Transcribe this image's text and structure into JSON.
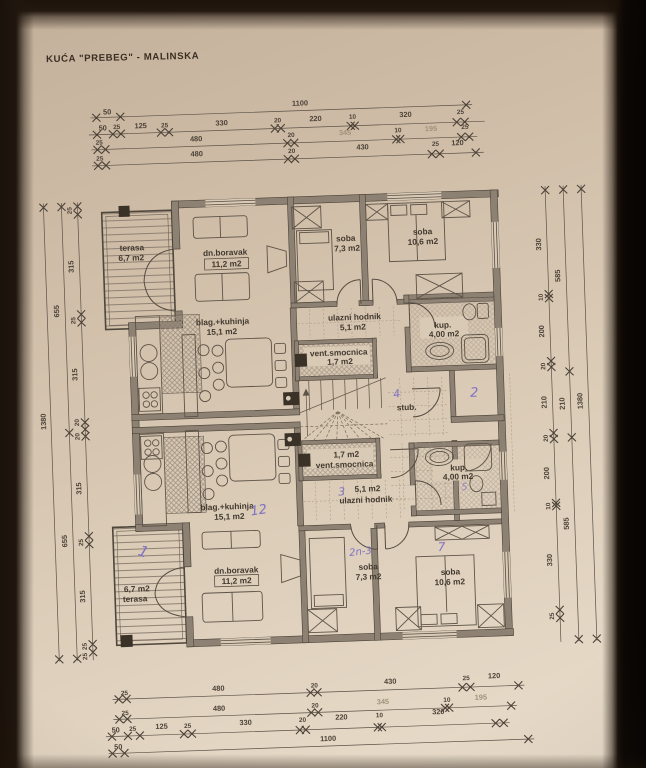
{
  "title": "KUĆA \"PREBEG\" - MALINSKA",
  "colors": {
    "paper": "#d8c9b4",
    "ink": "#4c4238",
    "wall_fill": "#8c8173",
    "handwriting": "#7e70c4",
    "faint_dim": "#a3927a"
  },
  "rooms": {
    "terasa_a": {
      "name": "terasa",
      "area": "6,7 m2"
    },
    "boravak_a": {
      "name": "dn.boravak",
      "area": "11,2 m2"
    },
    "soba_mala_a": {
      "name": "soba",
      "area": "7,3 m2"
    },
    "soba_velika_a": {
      "name": "soba",
      "area": "10,6 m2"
    },
    "kuhinja_a": {
      "name": "blag.+kuhinja",
      "area": "15,1 m2"
    },
    "hodnik_a": {
      "name": "ulazni hodnik",
      "area": "5,1 m2"
    },
    "smocnica_a": {
      "name": "vent.smocnica",
      "area": "1,7 m2"
    },
    "kup_a": {
      "name": "kup.",
      "area": "4,00 m2"
    },
    "stub": {
      "name": "stub."
    },
    "smocnica_b": {
      "name": "vent.smocnica",
      "area": "1,7 m2"
    },
    "hodnik_b": {
      "name": "ulazni hodnik",
      "area": "5,1 m2"
    },
    "kup_b": {
      "name": "kup.",
      "area": "4,00 m2"
    },
    "kuhinja_b": {
      "name": "blag.+kuhinja",
      "area": "15,1 m2"
    },
    "boravak_b": {
      "name": "dn.boravak",
      "area": "11,2 m2"
    },
    "terasa_b": {
      "name": "terasa",
      "area": "6,7 m2"
    },
    "soba_mala_b": {
      "name": "soba",
      "area": "7,3 m2"
    },
    "soba_velika_b": {
      "name": "soba",
      "area": "10,6 m2"
    }
  },
  "handwritten": {
    "stub_mark": "4",
    "room_mark": "2",
    "hodnik_mark": "3",
    "kuhinja_mark": "12",
    "soba_mala_mark": "2n-3",
    "soba_velika_mark": "7",
    "kup_mark": "5",
    "terasa_mark": "1"
  },
  "dims": {
    "top": {
      "r1": [
        "50",
        "1100"
      ],
      "r2": [
        "50",
        "25",
        "125",
        "25",
        "330",
        "20",
        "220",
        "10",
        "320",
        "25"
      ],
      "r3": [
        "25",
        "480",
        "20",
        "345",
        "10",
        "195",
        "25"
      ],
      "r4": [
        "25",
        "480",
        "20",
        "430",
        "25",
        "120"
      ]
    },
    "bottom": {
      "r1": [
        "25",
        "480",
        "20",
        "430",
        "25",
        "120"
      ],
      "r2": [
        "25",
        "480",
        "20",
        "345",
        "10",
        "195"
      ],
      "r3": [
        "50",
        "25",
        "125",
        "25",
        "330",
        "20",
        "220",
        "10",
        "320"
      ],
      "r4": [
        "50",
        "1100"
      ]
    },
    "left": {
      "inner": [
        "25",
        "315",
        "25",
        "315",
        "20",
        "20",
        "315",
        "25",
        "315",
        "25",
        "25"
      ],
      "mid": [
        "655",
        "655"
      ],
      "outer": [
        "1380"
      ]
    },
    "right": {
      "inner": [
        "330",
        "10",
        "200",
        "20",
        "210",
        "20",
        "200",
        "10",
        "330",
        "25"
      ],
      "mid": [
        "585",
        "210",
        "585"
      ],
      "outer": [
        "1380"
      ]
    }
  }
}
